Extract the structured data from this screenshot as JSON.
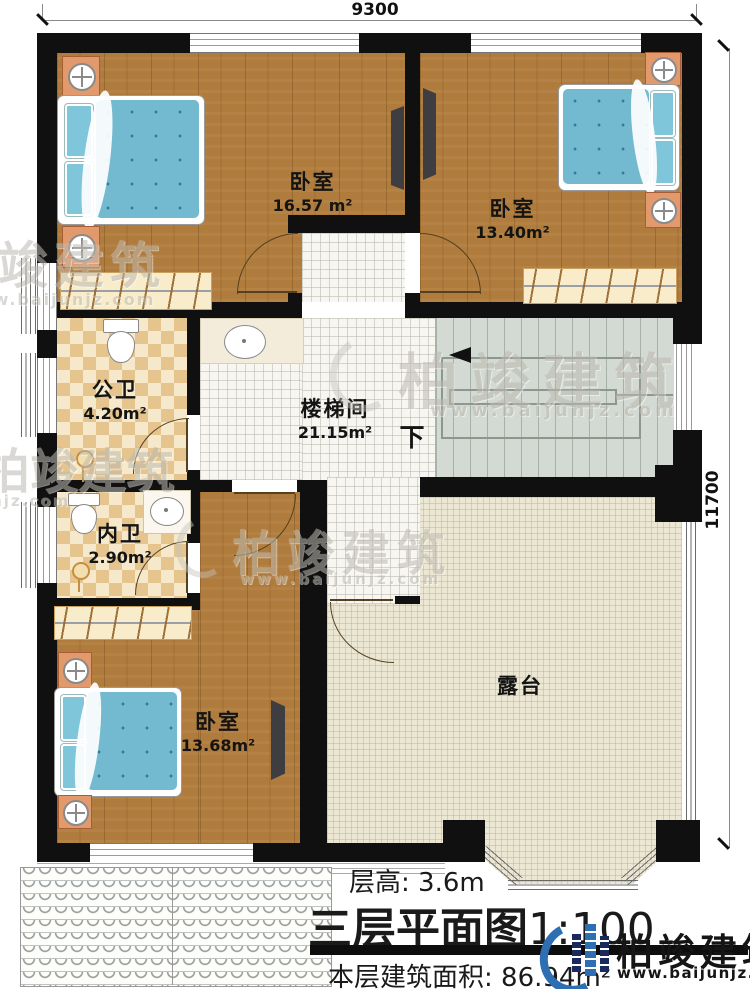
{
  "dimensions": {
    "top": "9300",
    "right": "11700"
  },
  "rooms": {
    "bedroom_top_left": {
      "name": "卧室",
      "area": "16.57 m²"
    },
    "bedroom_top_right": {
      "name": "卧室",
      "area": "13.40m²"
    },
    "public_bath": {
      "name": "公卫",
      "area": "4.20m²"
    },
    "stair_hall": {
      "name": "楼梯间",
      "area": "21.15m²"
    },
    "private_bath": {
      "name": "内卫",
      "area": "2.90m²"
    },
    "bedroom_bottom": {
      "name": "卧室",
      "area": "13.68m²"
    },
    "terrace": {
      "name": "露台"
    }
  },
  "stairs": {
    "direction_label": "下"
  },
  "title_block": {
    "floor_height_label": "层高:",
    "floor_height_value": "3.6m",
    "plan_title": "三层平面图",
    "plan_scale": "1:100",
    "area_label": "本层建筑面积:",
    "area_value": "86.94m²"
  },
  "watermark": {
    "brand": "柏竣建筑",
    "url": "www.baijunjz.com"
  },
  "logo": {
    "brand": "柏竣建筑",
    "url": "www.baijunjz.com"
  },
  "colors": {
    "wall": "#101010",
    "wood_floor": "#b07c3e",
    "hall_tile": "#f7f6f1",
    "bath_tile": "#e5c48e",
    "terrace": "#ece7d3",
    "stair": "#d3dad3",
    "mattress_blue": "#73bad0",
    "logo_blue": "#2e6fb3",
    "logo_navy": "#1b2a5e"
  }
}
